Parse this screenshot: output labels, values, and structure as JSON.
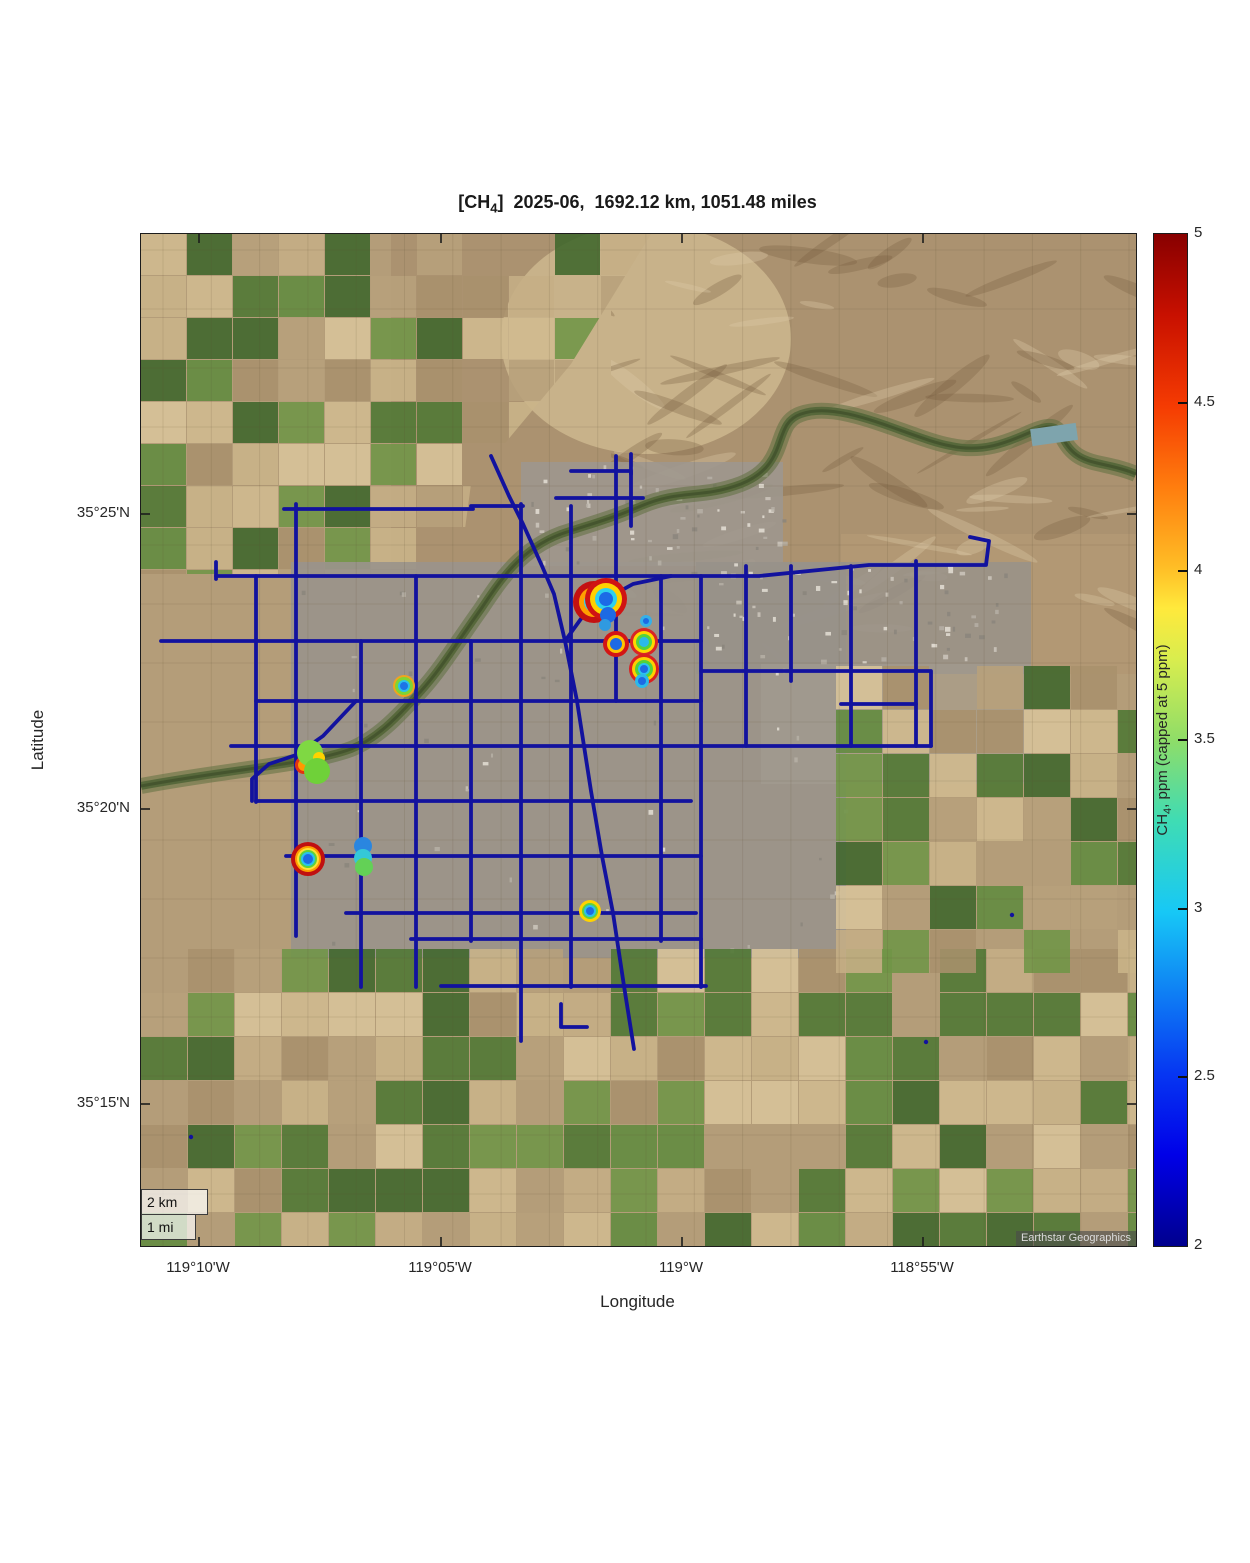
{
  "title": {
    "pre": "[CH",
    "sub": "4",
    "post": "]  2025-06,  1692.12 km, 1051.48 miles"
  },
  "axes": {
    "xlabel": "Longitude",
    "ylabel": "Latitude",
    "x_ticks": [
      {
        "label": "119°10'W",
        "px": 58
      },
      {
        "label": "119°05'W",
        "px": 300
      },
      {
        "label": "119°W",
        "px": 541
      },
      {
        "label": "118°55'W",
        "px": 782
      }
    ],
    "y_ticks": [
      {
        "label": "35°25'N",
        "px": 280
      },
      {
        "label": "35°20'N",
        "px": 575
      },
      {
        "label": "35°15'N",
        "px": 870
      }
    ]
  },
  "colorbar": {
    "label_pre": "CH",
    "label_sub": "4",
    "label_post": ", ppm (capped at 5 ppm)",
    "min": 2,
    "max": 5,
    "ticks": [
      5,
      4.5,
      4,
      3.5,
      3,
      2.5,
      2
    ],
    "colormap": "jet"
  },
  "map": {
    "scalebar_km": "2 km",
    "scalebar_mi": "1 mi",
    "attribution": "Earthstar Geographics"
  },
  "style": {
    "track_color": "#12129e",
    "track_width": 3.8,
    "accent_red": "#d01313",
    "accent_yellow": "#ffd000",
    "accent_green": "#5fd23a",
    "accent_cyan": "#2ac2ec",
    "accent_blue": "#1d6ae4"
  },
  "chart_data": {
    "type": "scatter",
    "title": "[CH4] 2025-06, 1692.12 km, 1051.48 miles",
    "month": "2025-06",
    "distance_km": 1692.12,
    "distance_miles": 1051.48,
    "xlabel": "Longitude",
    "ylabel": "Latitude",
    "x_range_deg": [
      "119°11.2'W",
      "118°50.6'W"
    ],
    "y_range_deg": [
      "35°13.6'N",
      "35°25.8'N"
    ],
    "colorbar_ppm_range": [
      2,
      5
    ],
    "legend_note": "Dark blue lines are mobile-survey driving tracks near baseline ~2 ppm; ringed spots are CH4 enhancements colored by jet colormap",
    "hotspots_lonlat": [
      {
        "lon": -119.0263,
        "lat": 35.3927,
        "peak_ppm_approx": 5.0
      },
      {
        "lon": -119.0228,
        "lat": 35.38,
        "peak_ppm_approx": 5.0
      },
      {
        "lon": -119.0132,
        "lat": 35.3805,
        "peak_ppm_approx": 4.6
      },
      {
        "lon": -119.0132,
        "lat": 35.3729,
        "peak_ppm_approx": 4.8
      },
      {
        "lon": -119.096,
        "lat": 35.368,
        "peak_ppm_approx": 3.8
      },
      {
        "lon": -119.1283,
        "lat": 35.3475,
        "peak_ppm_approx": 3.6
      },
      {
        "lon": -119.129,
        "lat": 35.3192,
        "peak_ppm_approx": 4.9
      },
      {
        "lon": -119.11,
        "lat": 35.32,
        "peak_ppm_approx": 3.2
      },
      {
        "lon": -119.0318,
        "lat": 35.3128,
        "peak_ppm_approx": 3.9
      }
    ],
    "tracks_px": [
      [
        [
          75,
          345
        ],
        [
          75,
          328
        ]
      ],
      [
        [
          75,
          342
        ],
        [
          618,
          342
        ],
        [
          728,
          331
        ],
        [
          845,
          331
        ],
        [
          848,
          307
        ],
        [
          829,
          303
        ]
      ],
      [
        [
          143,
          275
        ],
        [
          332,
          275
        ]
      ],
      [
        [
          155,
          270
        ],
        [
          155,
          702
        ]
      ],
      [
        [
          20,
          407
        ],
        [
          560,
          407
        ]
      ],
      [
        [
          115,
          342
        ],
        [
          115,
          568
        ]
      ],
      [
        [
          220,
          407
        ],
        [
          220,
          753
        ]
      ],
      [
        [
          275,
          342
        ],
        [
          275,
          753
        ]
      ],
      [
        [
          330,
          407
        ],
        [
          330,
          707
        ]
      ],
      [
        [
          380,
          270
        ],
        [
          380,
          807
        ]
      ],
      [
        [
          330,
          272
        ],
        [
          382,
          272
        ]
      ],
      [
        [
          430,
          272
        ],
        [
          430,
          753
        ]
      ],
      [
        [
          475,
          222
        ],
        [
          475,
          467
        ]
      ],
      [
        [
          520,
          342
        ],
        [
          520,
          707
        ]
      ],
      [
        [
          560,
          342
        ],
        [
          560,
          753
        ]
      ],
      [
        [
          605,
          332
        ],
        [
          605,
          512
        ]
      ],
      [
        [
          650,
          332
        ],
        [
          650,
          447
        ]
      ],
      [
        [
          710,
          332
        ],
        [
          710,
          512
        ]
      ],
      [
        [
          775,
          327
        ],
        [
          775,
          512
        ]
      ],
      [
        [
          90,
          512
        ],
        [
          790,
          512
        ]
      ],
      [
        [
          115,
          467
        ],
        [
          560,
          467
        ]
      ],
      [
        [
          115,
          567
        ],
        [
          550,
          567
        ]
      ],
      [
        [
          145,
          622
        ],
        [
          560,
          622
        ]
      ],
      [
        [
          205,
          679
        ],
        [
          555,
          679
        ]
      ],
      [
        [
          270,
          705
        ],
        [
          560,
          705
        ]
      ],
      [
        [
          300,
          752
        ],
        [
          565,
          752
        ]
      ],
      [
        [
          560,
          437
        ],
        [
          790,
          437
        ],
        [
          790,
          512
        ]
      ],
      [
        [
          700,
          470
        ],
        [
          775,
          470
        ]
      ],
      [
        [
          430,
          237
        ],
        [
          490,
          237
        ],
        [
          490,
          292
        ]
      ],
      [
        [
          415,
          264
        ],
        [
          502,
          264
        ]
      ],
      [
        [
          490,
          220
        ],
        [
          490,
          240
        ]
      ],
      [
        [
          350,
          222
        ],
        [
          368,
          262
        ],
        [
          382,
          290
        ],
        [
          401,
          332
        ],
        [
          413,
          360
        ],
        [
          424,
          407
        ],
        [
          436,
          467
        ],
        [
          450,
          557
        ],
        [
          461,
          622
        ],
        [
          472,
          679
        ],
        [
          483,
          752
        ],
        [
          493,
          815
        ]
      ],
      [
        [
          424,
          407
        ],
        [
          442,
          382
        ],
        [
          463,
          366
        ],
        [
          492,
          350
        ],
        [
          530,
          342
        ]
      ],
      [
        [
          215,
          467
        ],
        [
          182,
          502
        ],
        [
          155,
          521
        ],
        [
          128,
          530
        ],
        [
          111,
          545
        ],
        [
          111,
          567
        ]
      ],
      [
        [
          420,
          770
        ],
        [
          420,
          793
        ],
        [
          446,
          793
        ]
      ]
    ],
    "track_dots_px": [
      [
        785,
        808
      ],
      [
        871,
        681
      ],
      [
        50,
        903
      ]
    ],
    "hotspots_px": [
      {
        "x": 453,
        "y": 368,
        "rings": [
          [
            21,
            "#c41111"
          ],
          [
            15,
            "#ff9e00"
          ],
          [
            10,
            "#3ccfe8"
          ]
        ]
      },
      {
        "x": 465,
        "y": 365,
        "rings": [
          [
            21,
            "#d01313"
          ],
          [
            16,
            "#ffd000"
          ],
          [
            11,
            "#2ed0ee"
          ],
          [
            7,
            "#1c6ae6"
          ]
        ]
      },
      {
        "x": 467,
        "y": 381,
        "rings": [
          [
            8,
            "#1d6ae4"
          ]
        ]
      },
      {
        "x": 464,
        "y": 391,
        "rings": [
          [
            6,
            "#2f9ae0"
          ]
        ]
      },
      {
        "x": 505,
        "y": 387,
        "rings": [
          [
            6,
            "#35b0e8"
          ],
          [
            3,
            "#1d6ae4"
          ]
        ]
      },
      {
        "x": 475,
        "y": 410,
        "rings": [
          [
            13,
            "#d31515"
          ],
          [
            9,
            "#ffc400"
          ],
          [
            6,
            "#1d6ae4"
          ]
        ]
      },
      {
        "x": 503,
        "y": 408,
        "rings": [
          [
            14,
            "#d92525"
          ],
          [
            11,
            "#ffd800"
          ],
          [
            8,
            "#55d23c"
          ],
          [
            5,
            "#2bb9ea"
          ]
        ]
      },
      {
        "x": 503,
        "y": 435,
        "rings": [
          [
            15,
            "#d92020"
          ],
          [
            12,
            "#ffcf00"
          ],
          [
            9,
            "#54d13a"
          ],
          [
            6,
            "#2bc4ec"
          ],
          [
            4,
            "#1d6ae4"
          ]
        ]
      },
      {
        "x": 501,
        "y": 447,
        "rings": [
          [
            7,
            "#2bb9ea"
          ],
          [
            4,
            "#1d6ae4"
          ]
        ]
      },
      {
        "x": 263,
        "y": 452,
        "rings": [
          [
            11,
            "#f0a41e"
          ],
          [
            9,
            "#80d434"
          ],
          [
            6,
            "#2ac2ea"
          ],
          [
            4,
            "#1d74e6"
          ]
        ]
      },
      {
        "x": 163,
        "y": 531,
        "rings": [
          [
            9,
            "#e23311"
          ],
          [
            6,
            "#ff9900"
          ]
        ]
      },
      {
        "x": 169,
        "y": 519,
        "rings": [
          [
            13,
            "#7fd843"
          ]
        ]
      },
      {
        "x": 178,
        "y": 524,
        "rings": [
          [
            6,
            "#ffd300"
          ]
        ]
      },
      {
        "x": 176,
        "y": 537,
        "rings": [
          [
            13,
            "#6fd139"
          ]
        ]
      },
      {
        "x": 167,
        "y": 625,
        "rings": [
          [
            17,
            "#c01010"
          ],
          [
            13,
            "#ff9e00"
          ],
          [
            11,
            "#ffe135"
          ],
          [
            9,
            "#5fd23a"
          ],
          [
            7,
            "#2ac2ec"
          ],
          [
            5,
            "#1d6ae4"
          ]
        ]
      },
      {
        "x": 222,
        "y": 612,
        "rings": [
          [
            9,
            "#2a86e0"
          ]
        ]
      },
      {
        "x": 222,
        "y": 624,
        "rings": [
          [
            9,
            "#35c8d8"
          ]
        ]
      },
      {
        "x": 223,
        "y": 633,
        "rings": [
          [
            9,
            "#63d156"
          ]
        ]
      },
      {
        "x": 449,
        "y": 677,
        "rings": [
          [
            11,
            "#ffd300"
          ],
          [
            8,
            "#62d13e"
          ],
          [
            6,
            "#2cc0ea"
          ],
          [
            4,
            "#1d6ae4"
          ]
        ]
      }
    ]
  },
  "layout_hints": {
    "map": {
      "left": 140,
      "top": 233,
      "width": 995,
      "height": 1012
    },
    "grid": false,
    "legend_position": "colorbar-right"
  }
}
